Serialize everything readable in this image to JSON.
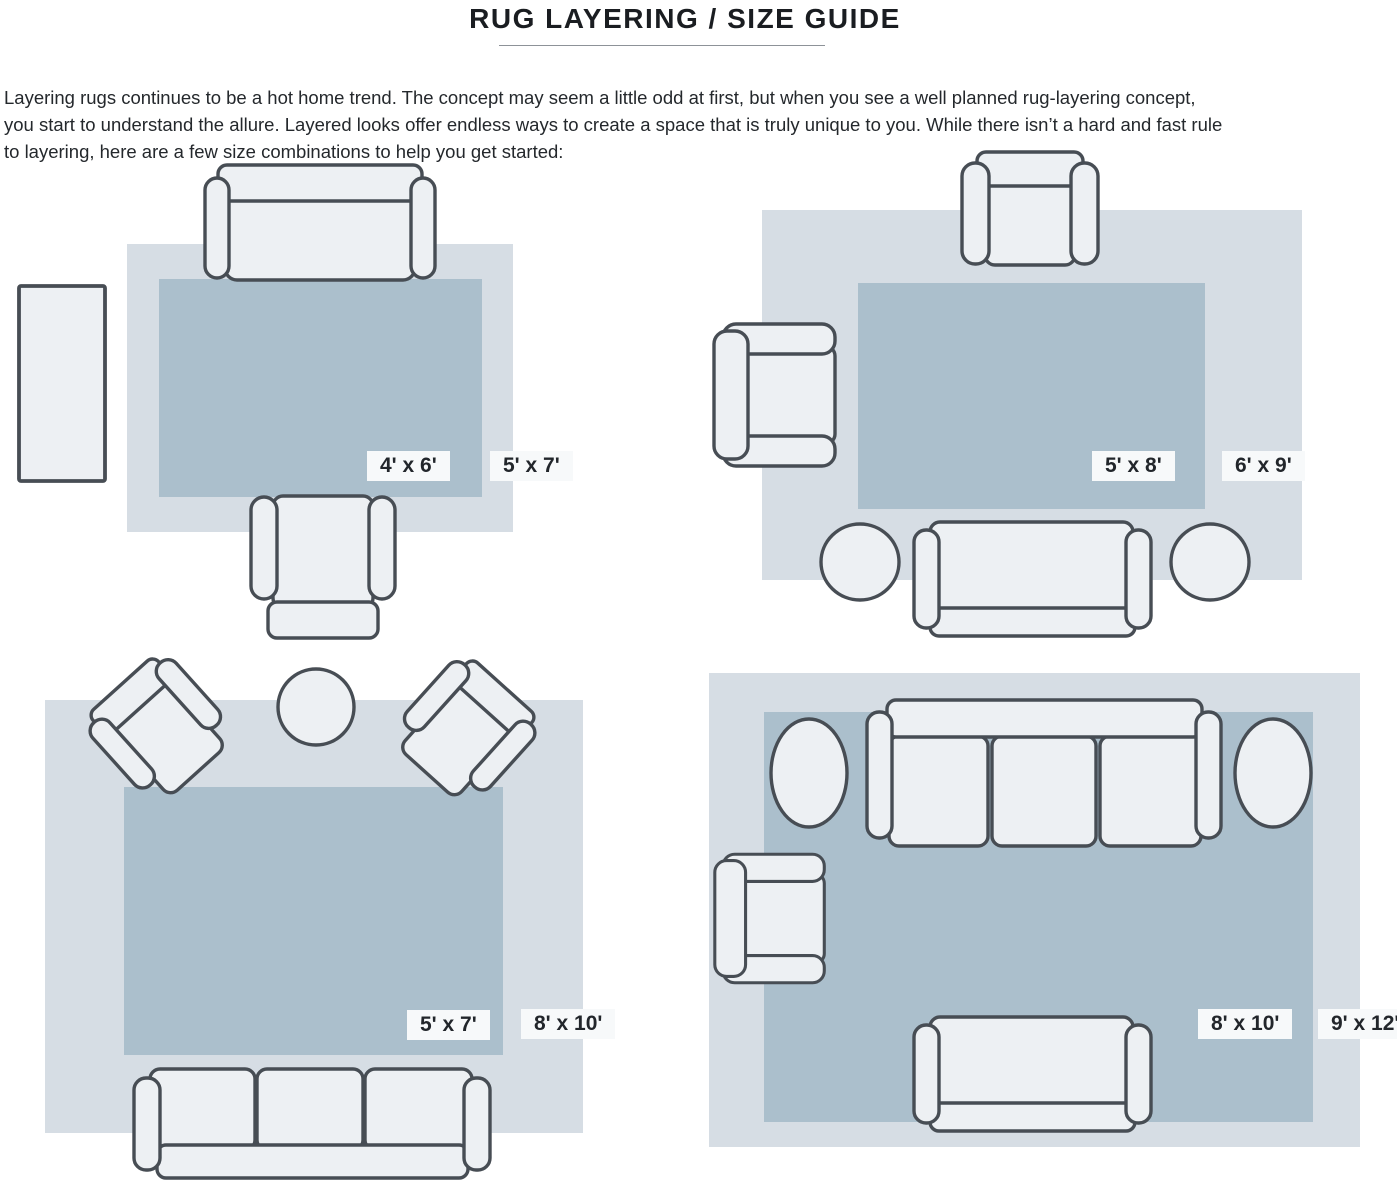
{
  "header": {
    "title": "RUG LAYERING / SIZE GUIDE",
    "intro_lines": [
      "Layering rugs continues to be a hot home trend. The concept may seem a little odd at first, but when you see a well planned rug-layering concept,",
      "you start to understand the allure. Layered looks offer endless ways to create a space that is truly unique to you. While there isn’t a hard and fast rule",
      "to layering, here are a few size combinations to help you get started:"
    ]
  },
  "colors": {
    "rug_outer": "#d6dde4",
    "rug_inner": "#abbfcc",
    "furn_fill": "#edf0f3",
    "furn_stroke": "#474d54",
    "badge_bg": "#f7f9fa",
    "badge_text": "#22262b",
    "title_color": "#1a1d21",
    "text_color": "#24282c",
    "rule_color": "#8d9298"
  },
  "diagrams": [
    {
      "position": "top-left",
      "inner_label": "4' x 6'",
      "outer_label": "5' x 7'",
      "furniture": [
        "sofa",
        "armchair",
        "console table"
      ]
    },
    {
      "position": "top-right",
      "inner_label": "5' x 8'",
      "outer_label": "6' x 9'",
      "furniture": [
        "armchair",
        "accent chair",
        "sofa",
        "2 round side tables"
      ]
    },
    {
      "position": "bottom-left",
      "inner_label": "5' x 7'",
      "outer_label": "8' x 10'",
      "furniture": [
        "2 angled armchairs",
        "round table",
        "3-seat sofa"
      ]
    },
    {
      "position": "bottom-right",
      "inner_label": "8' x 10'",
      "outer_label": "9' x 12'",
      "furniture": [
        "3-seat sofa",
        "2 oval side tables",
        "armchair",
        "loveseat"
      ]
    }
  ]
}
